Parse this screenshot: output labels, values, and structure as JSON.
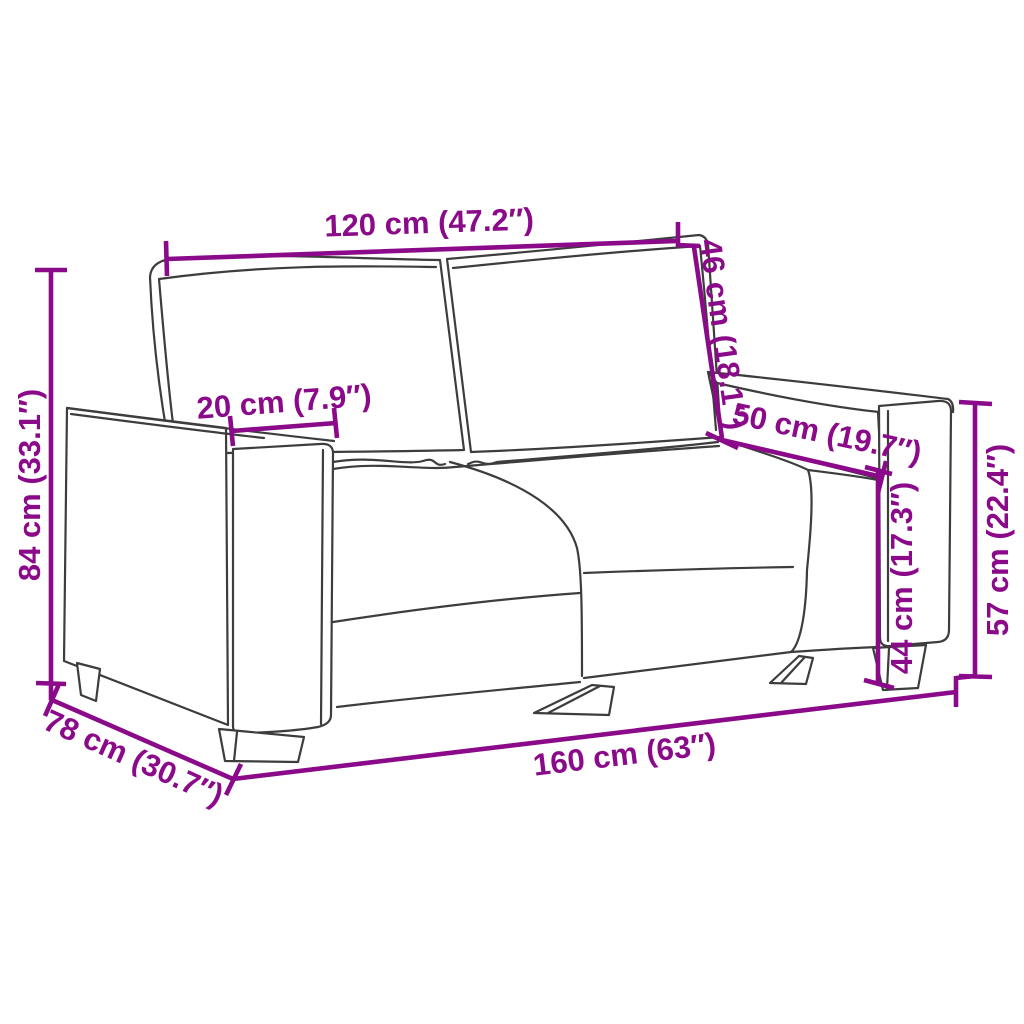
{
  "diagram": {
    "type": "furniture-dimension-diagram",
    "subject": "two-seater sofa line drawing with measurements",
    "background": "#ffffff",
    "colors": {
      "dimension": "#8a0a8a",
      "outline": "#3d3d3d"
    },
    "dimensions": [
      {
        "id": "backrest-width",
        "label": "120 cm (47.2″)",
        "cm": 120,
        "inches": 47.2
      },
      {
        "id": "backrest-height",
        "label": "46 cm (18.1″)",
        "cm": 46,
        "inches": 18.1
      },
      {
        "id": "armrest-width",
        "label": "20 cm (7.9″)",
        "cm": 20,
        "inches": 7.9
      },
      {
        "id": "seat-depth",
        "label": "50 cm (19.7″)",
        "cm": 50,
        "inches": 19.7
      },
      {
        "id": "overall-height",
        "label": "84 cm (33.1″)",
        "cm": 84,
        "inches": 33.1
      },
      {
        "id": "seat-height",
        "label": "44 cm (17.3″)",
        "cm": 44,
        "inches": 17.3
      },
      {
        "id": "armrest-height",
        "label": "57 cm (22.4″)",
        "cm": 57,
        "inches": 22.4
      },
      {
        "id": "overall-width",
        "label": "160 cm (63″)",
        "cm": 160,
        "inches": 63
      },
      {
        "id": "overall-depth",
        "label": "78 cm (30.7″)",
        "cm": 78,
        "inches": 30.7
      }
    ]
  }
}
